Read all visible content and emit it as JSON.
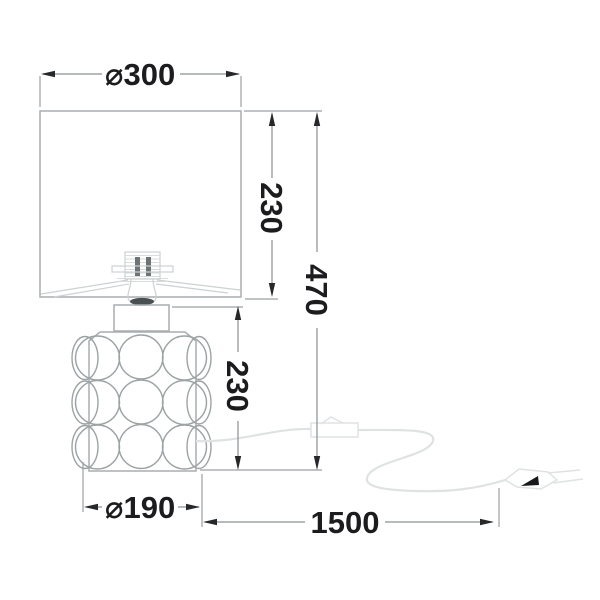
{
  "drawing": {
    "subject": "table lamp with bubble-textured base, shade, inline cable switch and plug",
    "view": "front elevation with dimensions"
  },
  "dimensions": {
    "shade_diameter": "⌀300",
    "shade_height": "230",
    "total_height": "470",
    "base_height": "230",
    "base_diameter": "⌀190",
    "cable_length": "1500"
  },
  "colors": {
    "background": "#ffffff",
    "text": "#1c1c1e",
    "dimension_line": "#8a9093",
    "extension_line": "#9aa0a3",
    "arrow": "#26282a",
    "lamp_outline": "#a8aeb0",
    "lamp_detail": "#cdd1d3",
    "cable": "#dfe2e3",
    "plug_mark": "#17181a"
  }
}
